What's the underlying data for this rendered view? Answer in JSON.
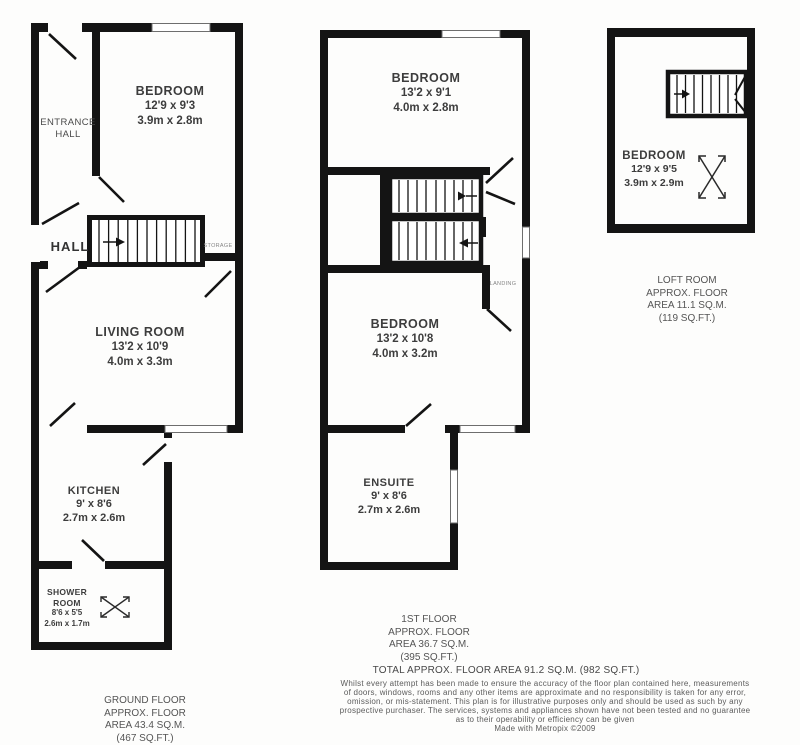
{
  "plans": {
    "ground": {
      "entrance_hall": {
        "line1": "ENTRANCE",
        "line2": "HALL"
      },
      "bedroom": {
        "name": "BEDROOM",
        "size_imperial": "12'9 x 9'3",
        "size_metric": "3.9m x 2.8m"
      },
      "hall": {
        "name": "HALL"
      },
      "storage": {
        "name": "STORAGE"
      },
      "living_room": {
        "name": "LIVING ROOM",
        "size_imperial": "13'2 x 10'9",
        "size_metric": "4.0m x 3.3m"
      },
      "kitchen": {
        "name": "KITCHEN",
        "size_imperial": "9' x 8'6",
        "size_metric": "2.7m x 2.6m"
      },
      "shower_room": {
        "line1": "SHOWER",
        "line2": "ROOM",
        "size_imperial": "8'6 x 5'5",
        "size_metric": "2.6m x 1.7m"
      },
      "caption": {
        "line1": "GROUND FLOOR",
        "line2": "APPROX. FLOOR",
        "line3": "AREA 43.4 SQ.M.",
        "line4": "(467 SQ.FT.)"
      }
    },
    "first_floor": {
      "bedroom_front": {
        "name": "BEDROOM",
        "size_imperial": "13'2 x 9'1",
        "size_metric": "4.0m x 2.8m"
      },
      "landing": {
        "name": "LANDING"
      },
      "bedroom_back": {
        "name": "BEDROOM",
        "size_imperial": "13'2 x 10'8",
        "size_metric": "4.0m x 3.2m"
      },
      "ensuite": {
        "name": "ENSUITE",
        "size_imperial": "9' x 8'6",
        "size_metric": "2.7m x 2.6m"
      },
      "caption": {
        "line1": "1ST FLOOR",
        "line2": "APPROX. FLOOR",
        "line3": "AREA 36.7 SQ.M.",
        "line4": "(395 SQ.FT.)"
      }
    },
    "loft": {
      "bedroom": {
        "name": "BEDROOM",
        "size_imperial": "12'9 x 9'5",
        "size_metric": "3.9m x 2.9m"
      },
      "caption": {
        "line1": "LOFT ROOM",
        "line2": "APPROX. FLOOR",
        "line3": "AREA 11.1 SQ.M.",
        "line4": "(119 SQ.FT.)"
      }
    }
  },
  "footer": {
    "total_area": "TOTAL APPROX. FLOOR AREA 91.2 SQ.M. (982 SQ.FT.)",
    "disclaimer": {
      "line1": "Whilst every attempt has been made to ensure the accuracy of the floor plan contained here, measurements",
      "line2": "of doors, windows, rooms and any other items are approximate and no responsibility is taken for any error,",
      "line3": "omission, or mis-statement. This plan is for illustrative purposes only and should be used as such by any",
      "line4": "prospective purchaser. The services, systems and appliances shown have not been tested and no guarantee",
      "line5": "as to their operability or efficiency can be given"
    },
    "credit": "Made with Metropix ©2009"
  },
  "colors": {
    "wall": "#141414",
    "label": "#3d3d3d",
    "small_label": "#858585",
    "caption": "#555555"
  }
}
